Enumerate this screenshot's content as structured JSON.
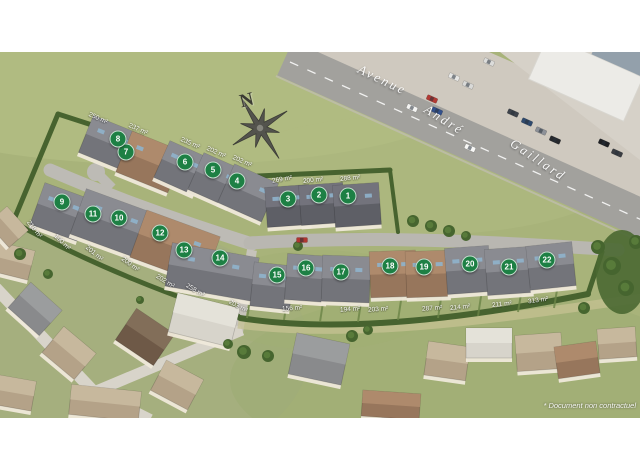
{
  "disclaimer": "* Document non contractuel",
  "compass": {
    "label": "N"
  },
  "streets": [
    {
      "text": "Avenue",
      "x": 356,
      "y": 72,
      "rot": 26
    },
    {
      "text": "André",
      "x": 422,
      "y": 112,
      "rot": 32
    },
    {
      "text": "Gaillard",
      "x": 506,
      "y": 152,
      "rot": 34
    }
  ],
  "colors": {
    "marker_green": "#1d8044",
    "hedge_green": "#47632f",
    "grass": "#a8b37a",
    "road_asphalt": "#a2a19d"
  },
  "lots": [
    {
      "num": "1",
      "area": "288 m²",
      "marker": {
        "x": 348,
        "y": 196
      },
      "label": {
        "x": 340,
        "y": 175,
        "rot": -6
      }
    },
    {
      "num": "2",
      "area": "200 m²",
      "marker": {
        "x": 319,
        "y": 195
      },
      "label": {
        "x": 303,
        "y": 177,
        "rot": -6
      }
    },
    {
      "num": "3",
      "area": "269 m²",
      "marker": {
        "x": 288,
        "y": 199
      },
      "label": {
        "x": 272,
        "y": 176,
        "rot": -10
      }
    },
    {
      "num": "4",
      "area": "202 m²",
      "marker": {
        "x": 237,
        "y": 181
      },
      "label": {
        "x": 232,
        "y": 158,
        "rot": 24
      }
    },
    {
      "num": "5",
      "area": "202 m²",
      "marker": {
        "x": 213,
        "y": 170
      },
      "label": {
        "x": 206,
        "y": 149,
        "rot": 24
      }
    },
    {
      "num": "6",
      "area": "235 m²",
      "marker": {
        "x": 185,
        "y": 162
      },
      "label": {
        "x": 180,
        "y": 140,
        "rot": 24
      }
    },
    {
      "num": "7",
      "area": "237 m²",
      "marker": {
        "x": 126,
        "y": 152
      },
      "label": {
        "x": 128,
        "y": 126,
        "rot": 24
      }
    },
    {
      "num": "8",
      "area": "250 m²",
      "marker": {
        "x": 118,
        "y": 139
      },
      "label": {
        "x": 88,
        "y": 115,
        "rot": 24
      }
    },
    {
      "num": "9",
      "area": "218 m²",
      "marker": {
        "x": 62,
        "y": 202
      },
      "label": {
        "x": 24,
        "y": 226,
        "rot": 52
      }
    },
    {
      "num": "10",
      "area": "201 m²",
      "marker": {
        "x": 119,
        "y": 218
      },
      "label": {
        "x": 84,
        "y": 250,
        "rot": 40
      }
    },
    {
      "num": "11",
      "area": "190 m²",
      "marker": {
        "x": 93,
        "y": 214
      },
      "label": {
        "x": 52,
        "y": 239,
        "rot": 45
      }
    },
    {
      "num": "12",
      "area": "200 m²",
      "marker": {
        "x": 160,
        "y": 233
      },
      "label": {
        "x": 120,
        "y": 261,
        "rot": 36
      }
    },
    {
      "num": "13",
      "area": "202 m²",
      "marker": {
        "x": 184,
        "y": 250
      },
      "label": {
        "x": 155,
        "y": 278,
        "rot": 32
      }
    },
    {
      "num": "14",
      "area": "258 m²",
      "marker": {
        "x": 220,
        "y": 258
      },
      "label": {
        "x": 185,
        "y": 287,
        "rot": 30
      }
    },
    {
      "num": "15",
      "area": "203 m²",
      "marker": {
        "x": 277,
        "y": 275
      },
      "label": {
        "x": 228,
        "y": 303,
        "rot": 28
      }
    },
    {
      "num": "16",
      "area": "156 m²",
      "marker": {
        "x": 306,
        "y": 268
      },
      "label": {
        "x": 282,
        "y": 305,
        "rot": -4
      }
    },
    {
      "num": "17",
      "area": "194 m²",
      "marker": {
        "x": 341,
        "y": 272
      },
      "label": {
        "x": 340,
        "y": 306,
        "rot": -4
      }
    },
    {
      "num": "18",
      "area": "203 m²",
      "marker": {
        "x": 390,
        "y": 266
      },
      "label": {
        "x": 368,
        "y": 306,
        "rot": -4
      }
    },
    {
      "num": "19",
      "area": "287 m²",
      "marker": {
        "x": 424,
        "y": 267
      },
      "label": {
        "x": 422,
        "y": 305,
        "rot": -4
      }
    },
    {
      "num": "20",
      "area": "214 m²",
      "marker": {
        "x": 470,
        "y": 264
      },
      "label": {
        "x": 450,
        "y": 304,
        "rot": -6
      }
    },
    {
      "num": "21",
      "area": "211 m²",
      "marker": {
        "x": 509,
        "y": 267
      },
      "label": {
        "x": 492,
        "y": 301,
        "rot": -6
      }
    },
    {
      "num": "22",
      "area": "313 m²",
      "marker": {
        "x": 547,
        "y": 260
      },
      "label": {
        "x": 528,
        "y": 297,
        "rot": -8
      }
    }
  ]
}
